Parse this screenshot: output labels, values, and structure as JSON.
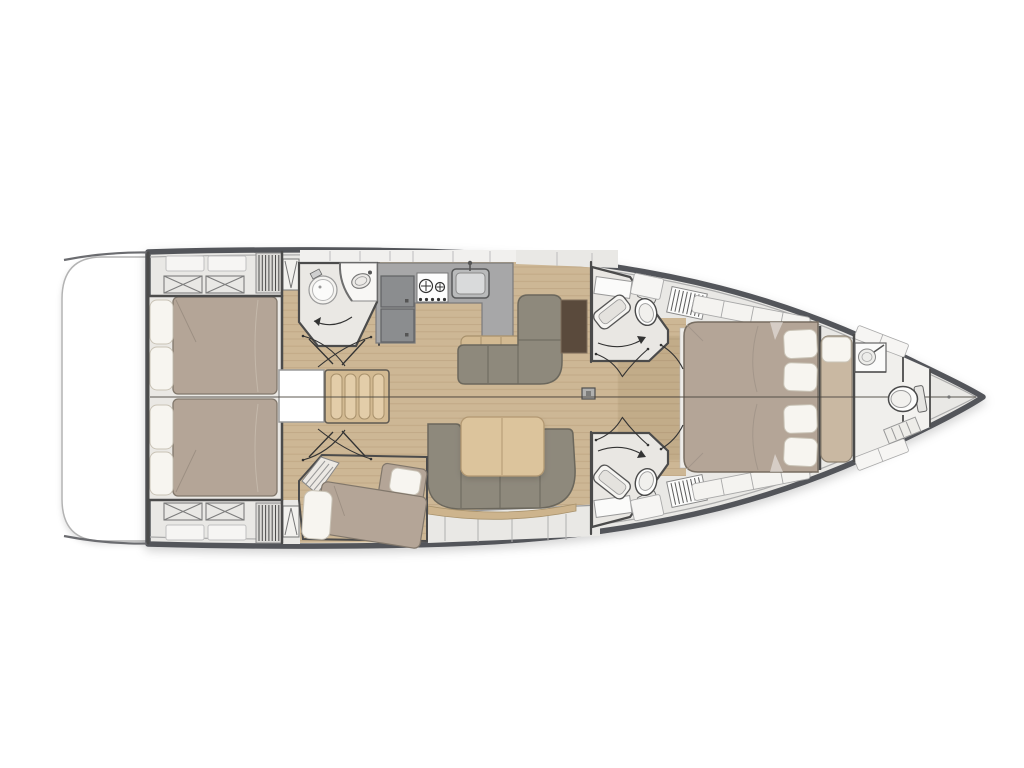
{
  "diagram": {
    "type": "yacht-interior-floor-plan",
    "view": "top-down",
    "orientation": {
      "bow": "right",
      "stern": "left",
      "port": "top",
      "starboard": "bottom"
    }
  },
  "rooms": [
    {
      "name": "Swim platform"
    },
    {
      "name": "Aft cabin port",
      "furniture": [
        "double bed",
        "pillows",
        "lockers"
      ]
    },
    {
      "name": "Aft cabin starboard",
      "furniture": [
        "double bed",
        "pillows",
        "lockers"
      ]
    },
    {
      "name": "Companionway",
      "furniture": [
        "stairs",
        "engine hatch"
      ]
    },
    {
      "name": "Aft head with shower",
      "furniture": [
        "round shower",
        "vanity basin"
      ]
    },
    {
      "name": "Galley",
      "furniture": [
        "refrigerator",
        "two-burner stove",
        "sink",
        "counter",
        "bench"
      ]
    },
    {
      "name": "Salon",
      "furniture": [
        "L-sofa",
        "chart table",
        "U-sofa",
        "dining table",
        "mast step"
      ]
    },
    {
      "name": "Mid cabin starboard",
      "furniture": [
        "angled berth",
        "pillows",
        "steps"
      ]
    },
    {
      "name": "Forward head port",
      "furniture": [
        "toilet",
        "basin",
        "cabinet",
        "louver vent"
      ]
    },
    {
      "name": "Forward head starboard",
      "furniture": [
        "toilet",
        "basin",
        "cabinet",
        "louver vent"
      ]
    },
    {
      "name": "Owner's cabin",
      "furniture": [
        "island double bed",
        "pillows",
        "side lockers",
        "bench seat"
      ]
    },
    {
      "name": "Bow crew compartment",
      "furniture": [
        "basin",
        "toilet",
        "steps"
      ]
    }
  ],
  "colors": {
    "hull_outline": "#53555a",
    "hull_inner": "#ababab",
    "deck": "#e9e8e5",
    "panel": "#f1f0ee",
    "wood": "#cdb795",
    "wood_line": "#b59c77",
    "room_floor": "#eae8e4",
    "wall": "#4b4b4b",
    "mattress": "#b4a597",
    "mattress_shade": "#9c8f82",
    "pillow": "#f7f5f0",
    "pillow_edge": "#c9c3b6",
    "sofa": "#8e897c",
    "sofa_edge": "#6b675c",
    "table_wood": "#dcc49c",
    "table_edge": "#b29872",
    "counter": "#a7a7a8",
    "counter_edge": "#7b7b7c",
    "appliance": "#8b8d8f",
    "chart_table": "#5a4a3c",
    "bench_wood": "#d3ba92",
    "bow_bench": "#c9b8a2",
    "white": "#ffffff",
    "line": "#333333",
    "seam": "rgba(75,70,64,0.6)"
  }
}
